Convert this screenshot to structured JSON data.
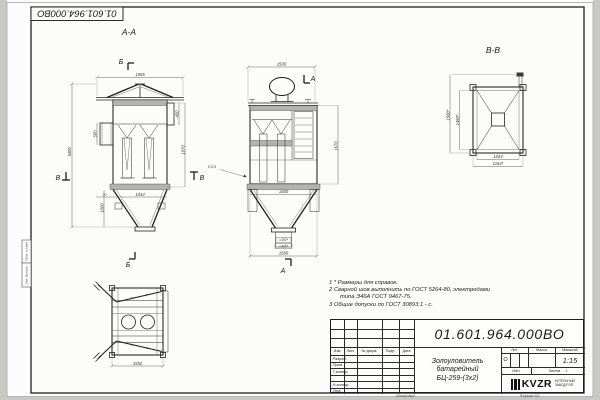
{
  "stamp": {
    "designation": "01.601.964.000ВО"
  },
  "frame": {
    "margin_box_top": "Подп. и дата",
    "margin_box_bottom": "Инв. № подл.",
    "footer_copied": "Копировал",
    "footer_format": "Формат А3"
  },
  "labels": {
    "section_aa": "А-А",
    "section_bb": "В-В",
    "mark_a": "А",
    "mark_b": "Б",
    "mark_v": "В",
    "weld": "П-5,5"
  },
  "dims": {
    "aa_top": "1555",
    "aa_height": "3400",
    "aa_inlet": "500",
    "aa_branch": "450",
    "aa_right": "1670",
    "aa_hopper_width": "1044",
    "aa_hopper_height": "1000",
    "aa_flange": "70",
    "front_top": "1500",
    "front_right": "1670",
    "front_hopper_top": "1480",
    "front_bottom": "1580",
    "front_outlet_inner": "□300*",
    "front_outlet_outer": "□400*",
    "bb_left_outer": "1580*",
    "bb_left_inner": "1460*",
    "bb_bottom_inner": "1044",
    "bb_bottom_outer": "1164*",
    "bottom_width": "1552"
  },
  "notes": {
    "line1": "1 * Размеры для справок.",
    "line2": "2 Сварной шов выполнить по ГОСТ 5264-80, электродами",
    "line3": "типа Э46А ГОСТ 9467-75.",
    "line4": "3 Общие допуски по ГОСТ 30893.1 - с."
  },
  "title_block": {
    "designation": "01.601.964.000ВО",
    "name_line1": "Золоуловитель",
    "name_line2": "батарейный",
    "name_line3": "БЦ-259-(3х2)",
    "col_izm": "Изм.",
    "col_list": "Лист",
    "col_doc": "№ докум.",
    "col_podp": "Подп.",
    "col_data": "Дата",
    "row_razrab": "Разраб.",
    "row_prov": "Пров.",
    "row_tkontr": "Т.контр.",
    "row_blank": "",
    "row_nkontr": "Н.контр.",
    "row_utv": "Утв.",
    "lit_label": "Лит.",
    "mass_label": "Масса",
    "scale_label": "Масштаб",
    "lit_value": "О",
    "scale_value": "1:15",
    "list_label": "Лист",
    "listov_label": "Листов",
    "listov_value": "1",
    "logo_text": "KVZR",
    "company_line1": "КОТЕЛЬНЫЙ",
    "company_line2": "ЗАВОД РЭП"
  }
}
